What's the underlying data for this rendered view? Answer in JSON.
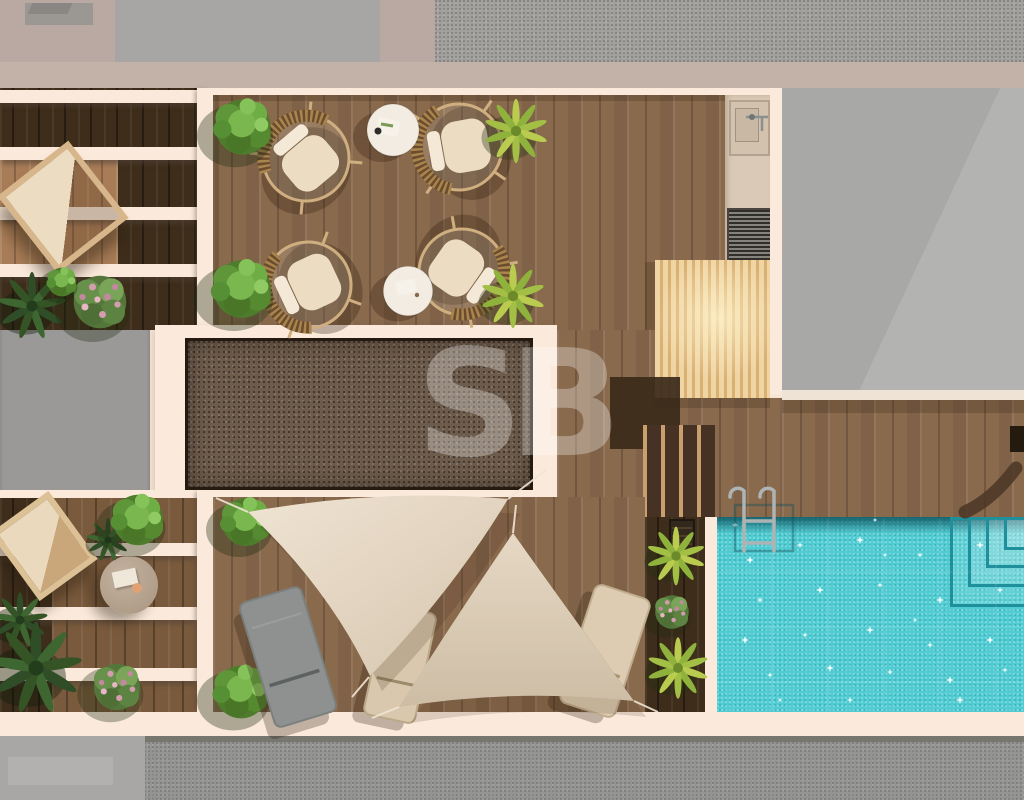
{
  "scene": {
    "type": "photorealistic top-down 3D render of a rooftop terrace floor plan",
    "watermark_text": "SB",
    "areas": [
      {
        "id": "upper-left-pergola",
        "desc": "slatted pergola with hanging lounge chair and flower bed"
      },
      {
        "id": "lounge-terrace",
        "desc": "timber deck with four round rattan chairs, two white side tables, box hedges and yucca palms"
      },
      {
        "id": "outdoor-kitchen-strip",
        "desc": "concrete strip with sink, tap and louvered utility unit"
      },
      {
        "id": "timber-canopy",
        "desc": "light slatted timber canopy"
      },
      {
        "id": "gravel-roof-panel",
        "desc": "recessed gravel roof panel with cream frame"
      },
      {
        "id": "pool-deck",
        "desc": "timber deck with access steps, curved bench shadow and chrome pool ladder"
      },
      {
        "id": "swimming-pool",
        "desc": "turquoise pool with sparkling water and corner entry steps"
      },
      {
        "id": "pool-planter",
        "desc": "planter bed with yucca palms and pink roses"
      },
      {
        "id": "sail-lounge-deck",
        "desc": "deck shaded by two triangular canvas sails with three sun loungers"
      },
      {
        "id": "lower-left-pergola",
        "desc": "slatted pergola with timber chair, round coffee table and planting"
      },
      {
        "id": "surroundings",
        "desc": "neighbouring grey roofs above and street below"
      }
    ],
    "object_counts": {
      "rattan_chairs": 4,
      "side_tables": 2,
      "sun_loungers": 3,
      "shade_sails": 2,
      "yucca_palms": 5,
      "green_bushes": 6,
      "pink_flower_beds": 4
    }
  },
  "palette": {
    "top_band": "#b9a9a2",
    "pink_band": "#c3b2a7",
    "roof_gray": "#a7a6a4",
    "roof_tex": "#a2a09d",
    "bldg_right": "#a8a8a6",
    "bldg_left": "#9a9998",
    "cream": "#f7e4d2",
    "cream_bright": "#fbeadb",
    "wood": "#8a6a4d",
    "wood_dark": "#3e2d1b",
    "wood_mid": "#7a5a3c",
    "wood_sun": "#a87c57",
    "solar_fill": "#6d5b4b",
    "solar_border": "#241a10",
    "pergola_light": "#f0d5a4",
    "pergola_stripe": "#d9af72",
    "concrete": "#d9c9b6",
    "vent_gray": "#6b675f",
    "pool": "#4fccd2",
    "pool_dark": "#135f68",
    "steps_line": "#1f8f9b",
    "sail1": "#e9dbc8",
    "sail2": "#dfd0bb",
    "lounger_gray": "#8e918f",
    "lounger_beige": "#d9c8ad",
    "rattan": "#cfae80",
    "cushion": "#ecdcc2",
    "white_table": "#f2ece2",
    "chrome": "#aeb4b4",
    "road": "#949492",
    "road_light": "#a8a7a5",
    "leaf": "#5f9639",
    "leaf_dark": "#2f4d26",
    "leaf_yellow": "#b9cc4f",
    "flower_pink": "#d59cb0"
  }
}
